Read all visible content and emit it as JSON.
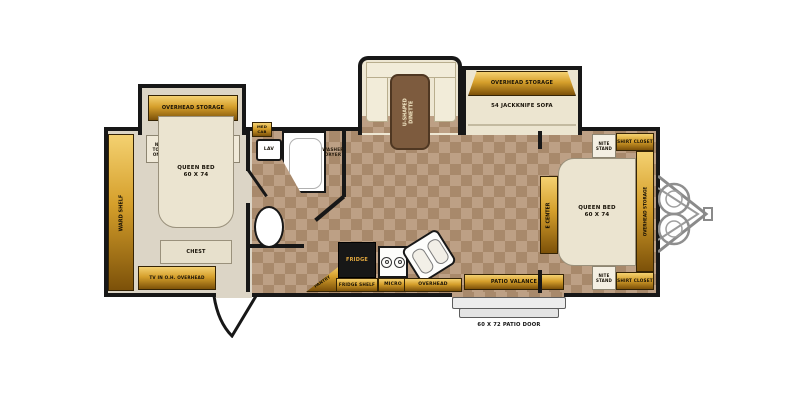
{
  "plan_title": "Travel Trailer Floor Plan",
  "colors": {
    "wall": "#171717",
    "cabinet_gold": "#d59f2b",
    "tile": "#b2957a",
    "carpet": "#dcd5c6",
    "furniture_cream": "#ebe4d0",
    "table_wood": "#7d5b3e"
  },
  "rear_bedroom": {
    "overhead_storage": "OVERHEAD STORAGE",
    "ns_left": "N/S\nTOPS ONLY",
    "ns_right": "N/S\nTOPS ONLY",
    "queen_bed": "QUEEN BED\n60 X 74",
    "ward_shelf": "WARD SHELF",
    "chest": "CHEST",
    "tv_overhead": "TV IN O.H. OVERHEAD"
  },
  "bathroom": {
    "med_cab": "MED\nCAB",
    "lav": "LAV",
    "washer_dryer": "WASHER\nDRYER"
  },
  "kitchen": {
    "dinette": "U-SHAPED\nDINETTE",
    "pantry": "PANTRY",
    "fridge": "FRIDGE",
    "fridge_shelf": "FRIDGE SHELF",
    "micro": "MICRO",
    "overhead": "OVERHEAD"
  },
  "living": {
    "overhead_storage": "OVERHEAD STORAGE",
    "sofa": "54  JACKKNIFE SOFA",
    "patio_valance": "PATIO VALANCE",
    "patio_door": "60 X 72 PATIO DOOR"
  },
  "front_bedroom": {
    "e_center": "E CENTER",
    "queen_bed": "QUEEN BED\n60 X 74",
    "nite_stand_top": "NITE\nSTAND",
    "nite_stand_bottom": "NITE\nSTAND",
    "shirt_closet_top": "SHIRT CLOSET",
    "shirt_closet_bottom": "SHIRT CLOSET",
    "overhead_storage": "OVERHEAD STORAGE"
  }
}
